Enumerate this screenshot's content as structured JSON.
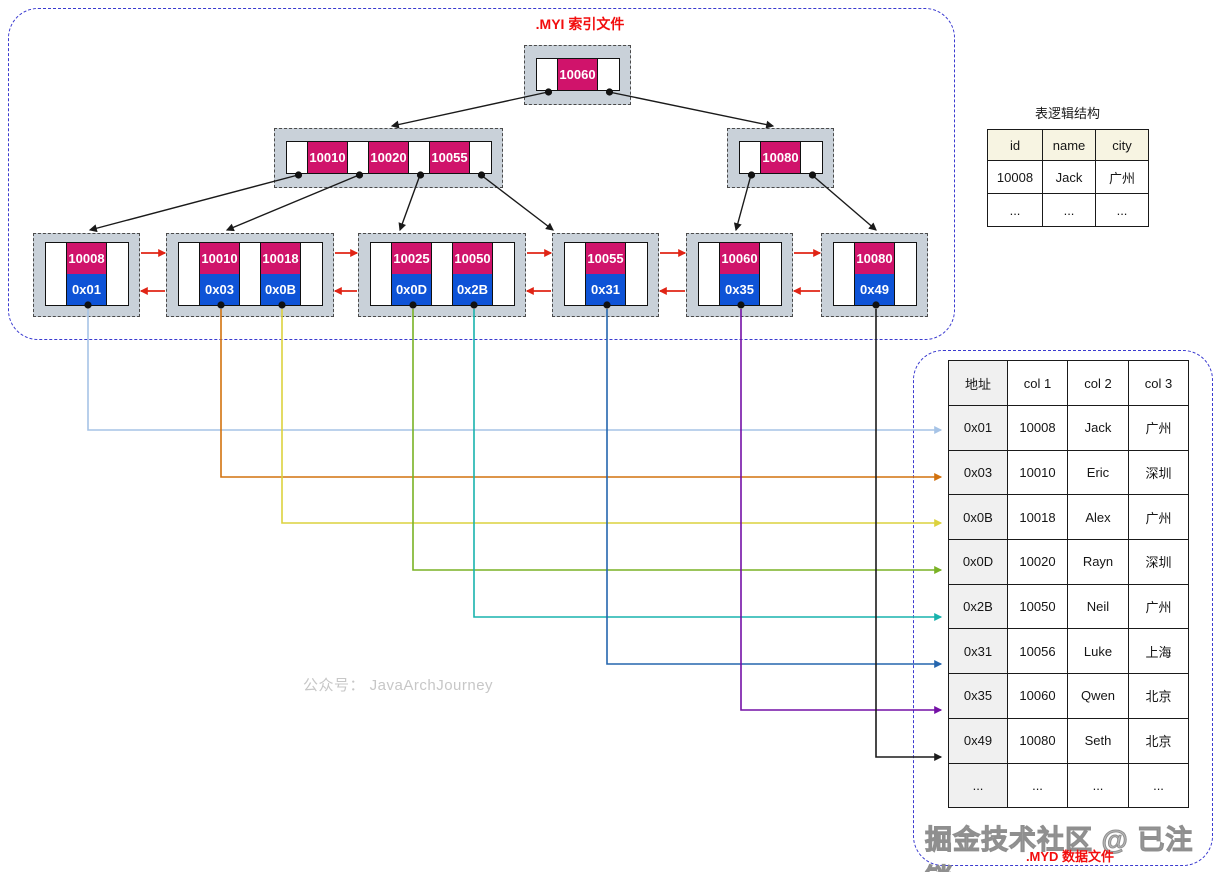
{
  "titles": {
    "myi": ".MYI 索引文件",
    "myd": ".MYD 数据文件",
    "logical": "表逻辑结构",
    "watermark_center": "公众号： JavaArchJourney",
    "watermark_bottom": "掘金技术社区 @ 已注销"
  },
  "colors": {
    "key_cell": "#d0136b",
    "addr_cell": "#0e53d7",
    "node_bg": "#c9d1d9",
    "container_border": "#3b3bd0",
    "red_link": "#e02415",
    "label_red": "#f20d0d",
    "tree_arrow": "#1a1a1a",
    "logical_header_bg": "#f7f4e2",
    "addr_col_bg": "#f0f0f0"
  },
  "tree": {
    "root": {
      "keys": [
        "10060"
      ]
    },
    "internal": [
      {
        "keys": [
          "10010",
          "10020",
          "10055"
        ]
      },
      {
        "keys": [
          "10080"
        ]
      }
    ],
    "leaves": [
      {
        "entries": [
          {
            "key": "10008",
            "addr": "0x01",
            "color": "#a6c3e6"
          }
        ]
      },
      {
        "entries": [
          {
            "key": "10010",
            "addr": "0x03",
            "color": "#d2720e"
          },
          {
            "key": "10018",
            "addr": "0x0B",
            "color": "#dcd23e"
          }
        ]
      },
      {
        "entries": [
          {
            "key": "10025",
            "addr": "0x0D",
            "color": "#7ab225"
          },
          {
            "key": "10050",
            "addr": "0x2B",
            "color": "#19b3ad"
          }
        ]
      },
      {
        "entries": [
          {
            "key": "10055",
            "addr": "0x31",
            "color": "#2566ae"
          }
        ]
      },
      {
        "entries": [
          {
            "key": "10060",
            "addr": "0x35",
            "color": "#7410a6"
          }
        ]
      },
      {
        "entries": [
          {
            "key": "10080",
            "addr": "0x49",
            "color": "#1c1c1c"
          }
        ]
      }
    ]
  },
  "logical_table": {
    "headers": [
      "id",
      "name",
      "city"
    ],
    "rows": [
      [
        "10008",
        "Jack",
        "广州"
      ],
      [
        "...",
        "...",
        "..."
      ]
    ]
  },
  "data_table": {
    "headers": [
      "地址",
      "col 1",
      "col 2",
      "col 3"
    ],
    "rows": [
      [
        "0x01",
        "10008",
        "Jack",
        "广州"
      ],
      [
        "0x03",
        "10010",
        "Eric",
        "深圳"
      ],
      [
        "0x0B",
        "10018",
        "Alex",
        "广州"
      ],
      [
        "0x0D",
        "10020",
        "Rayn",
        "深圳"
      ],
      [
        "0x2B",
        "10050",
        "Neil",
        "广州"
      ],
      [
        "0x31",
        "10056",
        "Luke",
        "上海"
      ],
      [
        "0x35",
        "10060",
        "Qwen",
        "北京"
      ],
      [
        "0x49",
        "10080",
        "Seth",
        "北京"
      ],
      [
        "...",
        "...",
        "...",
        "..."
      ]
    ]
  }
}
